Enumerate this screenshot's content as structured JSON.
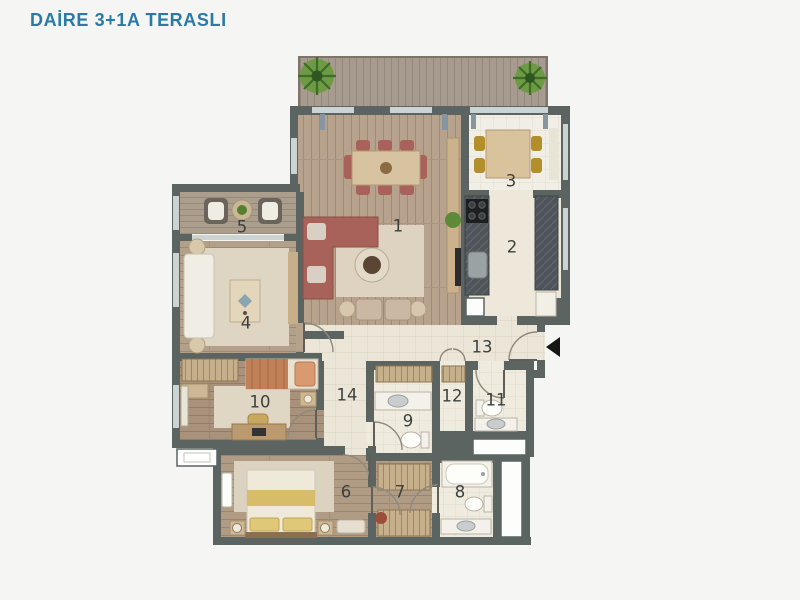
{
  "title": "DAİRE 3+1A TERASLI",
  "title_color": "#2a7aa6",
  "floorplan": {
    "entrance_marker": "entrance-arrow-left",
    "room_labels": [
      {
        "number": "1",
        "x": 398,
        "y": 226
      },
      {
        "number": "2",
        "x": 512,
        "y": 247
      },
      {
        "number": "3",
        "x": 511,
        "y": 181
      },
      {
        "number": "4",
        "x": 246,
        "y": 323
      },
      {
        "number": "5",
        "x": 242,
        "y": 227
      },
      {
        "number": "6",
        "x": 346,
        "y": 492
      },
      {
        "number": "7",
        "x": 400,
        "y": 492
      },
      {
        "number": "8",
        "x": 460,
        "y": 492
      },
      {
        "number": "9",
        "x": 408,
        "y": 421
      },
      {
        "number": "10",
        "x": 260,
        "y": 402
      },
      {
        "number": "11",
        "x": 496,
        "y": 400
      },
      {
        "number": "12",
        "x": 452,
        "y": 396
      },
      {
        "number": "13",
        "x": 482,
        "y": 347
      },
      {
        "number": "14",
        "x": 347,
        "y": 395
      }
    ]
  }
}
